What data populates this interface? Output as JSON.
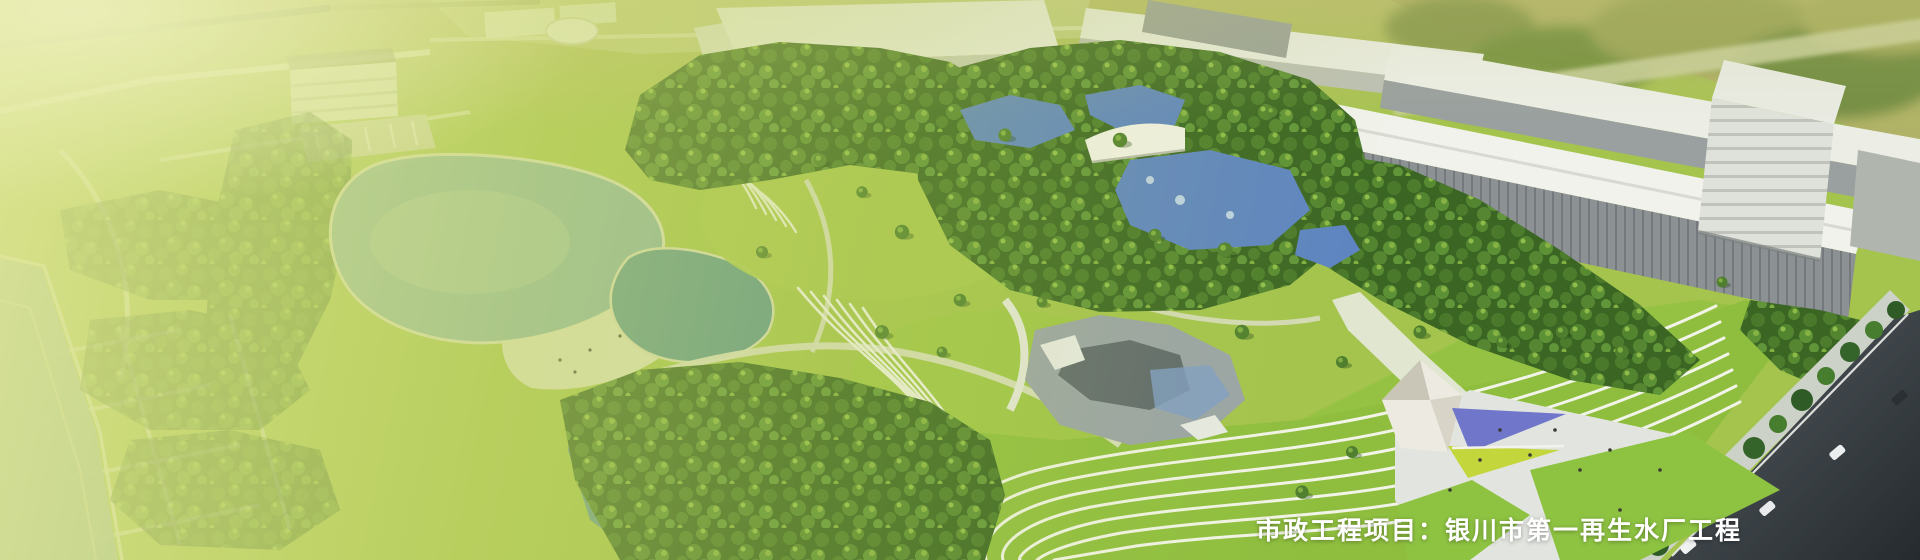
{
  "banner": {
    "caption": "市政工程项目：银川市第一再生水厂工程"
  },
  "palette": {
    "grass": "#a4c44d",
    "lake_teal": "#8ab4a1",
    "pond_teal": "#5f978b",
    "wetland_teal": "#67988c",
    "pool_blue": "#5d84c2",
    "pavilion_blue": "#7076c9",
    "pavilion_yellow": "#c3d63b",
    "road_dark": "#3a4145",
    "caption_text": "#ffffff"
  }
}
